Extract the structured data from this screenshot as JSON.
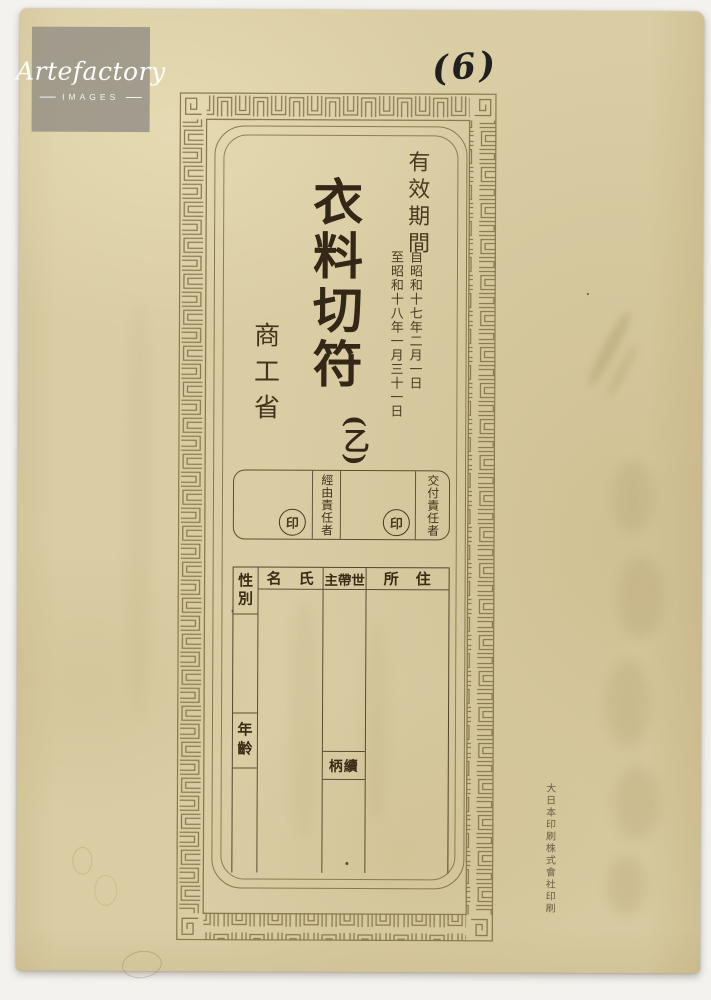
{
  "watermark": {
    "brand": "Artefactory",
    "subtitle": "IMAGES"
  },
  "annotation": {
    "page_number": "(6)"
  },
  "ticket": {
    "title": "衣料切符",
    "class_mark": "(乙)",
    "issuer": "商工省",
    "validity": {
      "heading": "有效期間",
      "from": "自昭和十七年二月一日",
      "to": "至昭和十八年一月三十一日"
    },
    "stamps": {
      "via_label": "經由責任者",
      "issue_label": "交付責任者",
      "seal_char": "印"
    },
    "table": {
      "sex_header": "性別",
      "name_header": "名　氏",
      "household_header": "主帶世",
      "address_header": "所　住",
      "age_label": "年齡",
      "relation_label": "柄續"
    },
    "printer_credit": "大日本印刷株式會社印刷"
  },
  "colors": {
    "paper": "#dacda4",
    "frame_line": "#8b7a50",
    "ink": "#332817",
    "table_line": "#4c3c22"
  }
}
